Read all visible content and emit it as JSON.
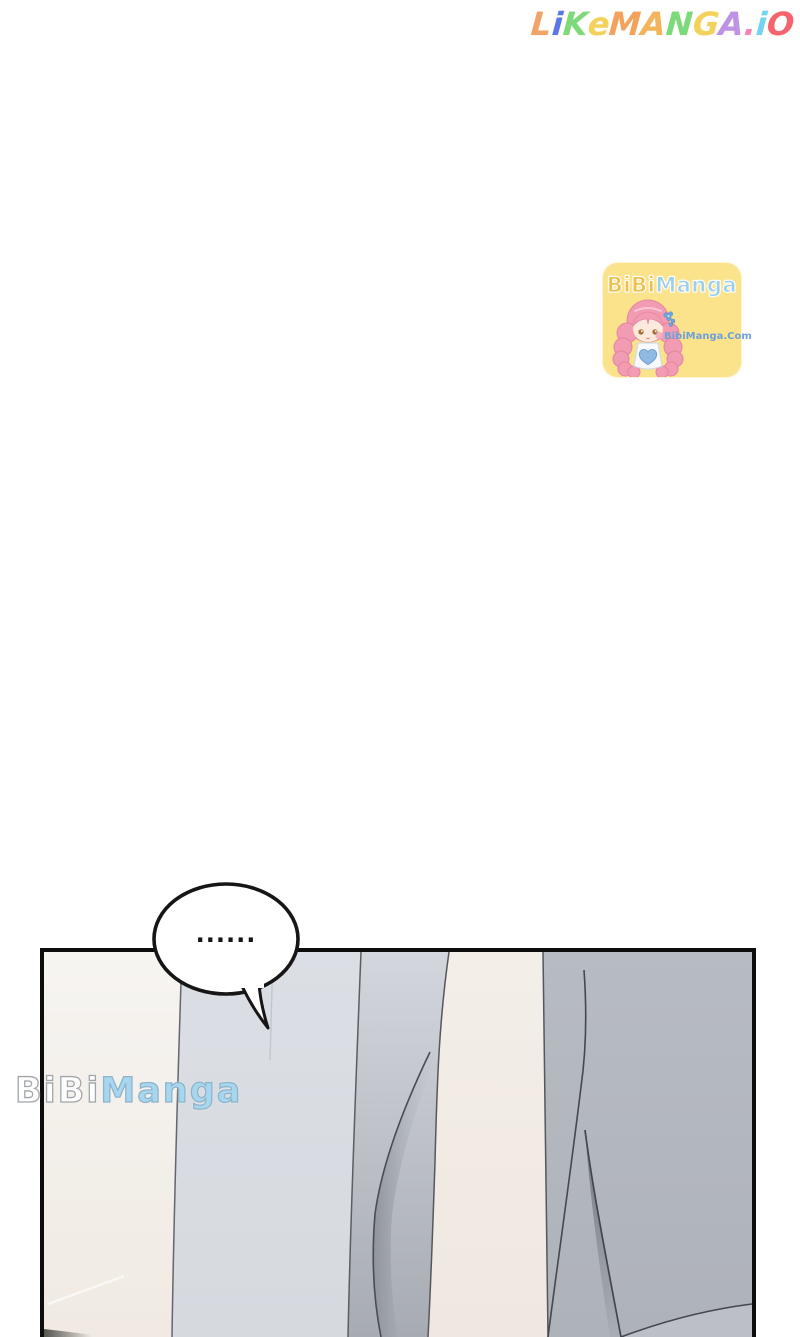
{
  "site_logo": {
    "text": "LikeManga.io",
    "letters": [
      {
        "ch": "L",
        "color": "#F2A468"
      },
      {
        "ch": "i",
        "color": "#5B78E8"
      },
      {
        "ch": "K",
        "color": "#7CD97C"
      },
      {
        "ch": "e",
        "color": "#F2D25A"
      },
      {
        "ch": "M",
        "color": "#F2A25C"
      },
      {
        "ch": "A",
        "color": "#F2B45C"
      },
      {
        "ch": "N",
        "color": "#7CD97C"
      },
      {
        "ch": "G",
        "color": "#F2D25A"
      },
      {
        "ch": "A",
        "color": "#BD93E5"
      },
      {
        "ch": ".",
        "color": "#F584B4"
      },
      {
        "ch": "i",
        "color": "#72D4F0"
      },
      {
        "ch": "O",
        "color": "#F4636E"
      }
    ]
  },
  "bibimanga_badge": {
    "title_bibi": "BiBi",
    "title_manga": "Manga",
    "site_url": "BibiManga.Com"
  },
  "panel_watermark": {
    "bibi": "BiBi",
    "manga": "Manga"
  },
  "speech_bubble": {
    "text": "......"
  },
  "colors": {
    "badge_bg": "#FAE38B",
    "badge_bibi": "#EFBE4E",
    "badge_manga": "#9CCFEA",
    "badge_url": "#6FA0D8",
    "wm_manga": "#A7D6EF",
    "ink": "#141414",
    "panel_cream_left": "#F2EEE8",
    "panel_gray_light": "#D9DDE2",
    "panel_gray_mid": "#BFC3CA",
    "panel_cream_column": "#F1EBE4",
    "panel_gray_right": "#B3B7BE",
    "panel_fold_line": "#4A4D53"
  }
}
